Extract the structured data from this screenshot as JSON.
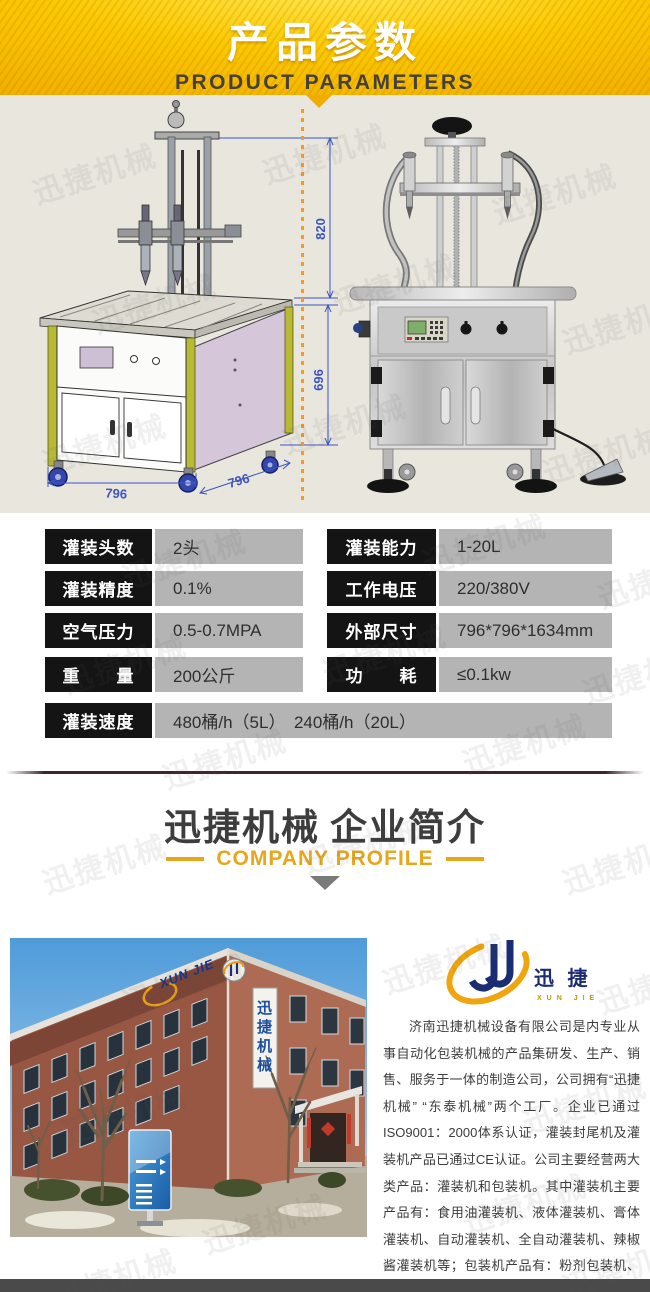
{
  "watermark": {
    "text": "迅捷机械"
  },
  "header": {
    "title": "产品参数",
    "subtitle": "PRODUCT PARAMETERS"
  },
  "diagram": {
    "dims": {
      "height_upper": "820",
      "height_lower": "696",
      "width_front": "796",
      "depth_side": "796"
    }
  },
  "params": {
    "rows_left": [
      {
        "label": "灌装头数",
        "value": "2头"
      },
      {
        "label": "灌装精度",
        "value": "0.1%"
      },
      {
        "label": "空气压力",
        "value": "0.5-0.7MPA"
      },
      {
        "label": "重　　量",
        "value": "200公斤"
      }
    ],
    "rows_right": [
      {
        "label": "灌装能力",
        "value": "1-20L"
      },
      {
        "label": "工作电压",
        "value": "220/380V"
      },
      {
        "label": "外部尺寸",
        "value": "796*796*1634mm"
      },
      {
        "label": "功　　耗",
        "value": "≤0.1kw"
      }
    ],
    "row_full": {
      "label": "灌装速度",
      "value": "480桶/h（5L）　240桶/h（20L）"
    }
  },
  "company": {
    "title_brand": "迅捷机械",
    "title_main": "企业简介",
    "subtitle": "COMPANY PROFILE",
    "logo": {
      "cn": "迅 捷",
      "en": "XUN JIE"
    },
    "building": {
      "sign_cn_vertical": "迅捷机械",
      "sign_en": "XUN JIE"
    },
    "profile": "济南迅捷机械设备有限公司是内专业从事自动化包装机械的产品集研发、生产、销售、服务于一体的制造公司，公司拥有“迅捷机械” “东泰机械”两个工厂。企业已通过ISO9001：2000体系认证，灌装封尾机及灌装机产品已通过CE认证。公司主要经营两大类产品：灌装机和包装机。其中灌装机主要产品有：食用油灌装机、液体灌装机、膏体灌装机、自动灌装机、全自动灌装机、辣椒酱灌装机等；包装机产品有：粉剂包装机、颗粒包装机、液体包装机、自动包装机、真空包装机等。"
  },
  "colors": {
    "header_gold": "#fbc900",
    "accent_gold": "#e6a71c",
    "table_label_bg": "#141414",
    "table_value_bg": "#b4b4b4",
    "band_bg": "#e9e6de",
    "dim_blue": "#3c55c0",
    "footer_bar": "#4a4a4a"
  }
}
